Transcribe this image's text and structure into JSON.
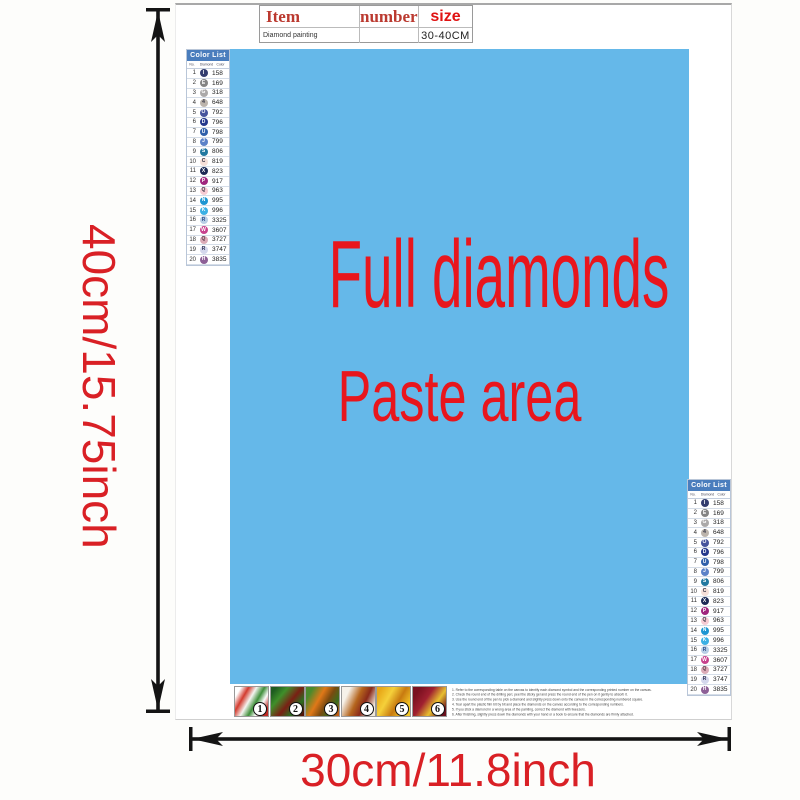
{
  "item_table": {
    "headers": [
      "Item",
      "number",
      "size"
    ],
    "row": {
      "item": "Diamond painting",
      "number": "",
      "size": "30-40CM"
    }
  },
  "paste_area": {
    "line1": "Full diamonds",
    "line2": "Paste area",
    "bg_color": "#65b8e9",
    "text_color": "#e8161d"
  },
  "dimensions": {
    "height_label": "40cm/15.75inch",
    "width_label": "30cm/11.8inch",
    "label_color": "#d92025",
    "arrow_color": "#141414"
  },
  "color_list": {
    "title": "Color List",
    "header_bg": "#4a7dbd",
    "columns": [
      "No.",
      "Diamond",
      "Color"
    ],
    "rows": [
      {
        "no": 1,
        "symbol": "I",
        "code": "158",
        "color": "#333c6e",
        "fg": "#ffffff"
      },
      {
        "no": 2,
        "symbol": "E",
        "code": "169",
        "color": "#848484",
        "fg": "#ffffff"
      },
      {
        "no": 3,
        "symbol": "G",
        "code": "318",
        "color": "#aba9a9",
        "fg": "#ffffff"
      },
      {
        "no": 4,
        "symbol": "4",
        "code": "648",
        "color": "#bcb4ac",
        "fg": "#333344"
      },
      {
        "no": 5,
        "symbol": "O",
        "code": "792",
        "color": "#46549c",
        "fg": "#ffffff"
      },
      {
        "no": 6,
        "symbol": "D",
        "code": "796",
        "color": "#24388c",
        "fg": "#ffffff"
      },
      {
        "no": 7,
        "symbol": "U",
        "code": "798",
        "color": "#3060aa",
        "fg": "#ffffff"
      },
      {
        "no": 8,
        "symbol": "J",
        "code": "799",
        "color": "#5b82c8",
        "fg": "#ffffff"
      },
      {
        "no": 9,
        "symbol": "S",
        "code": "806",
        "color": "#2278a0",
        "fg": "#ffffff"
      },
      {
        "no": 10,
        "symbol": "C",
        "code": "819",
        "color": "#f6dfd8",
        "fg": "#333344"
      },
      {
        "no": 11,
        "symbol": "X",
        "code": "823",
        "color": "#1d2a56",
        "fg": "#ffffff"
      },
      {
        "no": 12,
        "symbol": "P",
        "code": "917",
        "color": "#a0257e",
        "fg": "#ffffff"
      },
      {
        "no": 13,
        "symbol": "Q",
        "code": "963",
        "color": "#f7cbd3",
        "fg": "#333344"
      },
      {
        "no": 14,
        "symbol": "N",
        "code": "995",
        "color": "#1e96d2",
        "fg": "#ffffff"
      },
      {
        "no": 15,
        "symbol": "K",
        "code": "996",
        "color": "#3bb0e4",
        "fg": "#ffffff"
      },
      {
        "no": 16,
        "symbol": "R",
        "code": "3325",
        "color": "#b8cfe6",
        "fg": "#2a4a8a"
      },
      {
        "no": 17,
        "symbol": "W",
        "code": "3607",
        "color": "#c8428e",
        "fg": "#ffffff"
      },
      {
        "no": 18,
        "symbol": "Q",
        "code": "3727",
        "color": "#dbabb7",
        "fg": "#553344"
      },
      {
        "no": 19,
        "symbol": "R",
        "code": "3747",
        "color": "#d3d7ec",
        "fg": "#333355"
      },
      {
        "no": 20,
        "symbol": "H",
        "code": "3835",
        "color": "#8c5f96",
        "fg": "#ffffff"
      }
    ]
  },
  "thumbnails": [
    {
      "number": "1",
      "gradient": "linear-gradient(120deg,#ffffff 12%,#d33b2f 28%,#f4f4f0 44%,#3f8f3a 60%,#fdfdfd 74%,#c02a24 90%)"
    },
    {
      "number": "2",
      "gradient": "linear-gradient(130deg,#1e5c20 10%,#3f8f2a 30%,#7a1f14 55%,#2c6e22 75%,#521208 95%)"
    },
    {
      "number": "3",
      "gradient": "linear-gradient(120deg,#4a8a2c 15%,#e07818 40%,#7a4a10 60%,#3a6e1e 80%,#c05a12 95%)"
    },
    {
      "number": "4",
      "gradient": "linear-gradient(115deg,#f6f2ea 18%,#b5651d 45%,#8a2a1a 65%,#f0e8da 88%)"
    },
    {
      "number": "5",
      "gradient": "linear-gradient(120deg,#e8a818 10%,#f5d03a 35%,#c87a10 60%,#f2c528 85%)"
    },
    {
      "number": "6",
      "gradient": "linear-gradient(125deg,#7a1020 15%,#a02030 40%,#e8c030 65%,#6a0e1c 90%)"
    }
  ],
  "instructions": {
    "lines": [
      "1. Refer to the corresponding table on the canvas to identify each diamond symbol and the corresponding printed number on the canvas.",
      "2. Check the round end of the drilling pen; peel the sticky gel and press the round end of the pen on it gently to absorb it.",
      "3. Use the round end of the pen to pick a diamond and slightly press down onto the canvas in the corresponding numbered square.",
      "4. Tear apart the plastic film bit by bit and place the diamonds on the canvas according to the corresponding numbers.",
      "5. If you stick a diamond in a wrong area of the painting, correct the diamond with tweezers.",
      "6. After finishing, slightly press down the diamonds with your hand or a book to ensure that the diamonds are firmly attached."
    ]
  }
}
